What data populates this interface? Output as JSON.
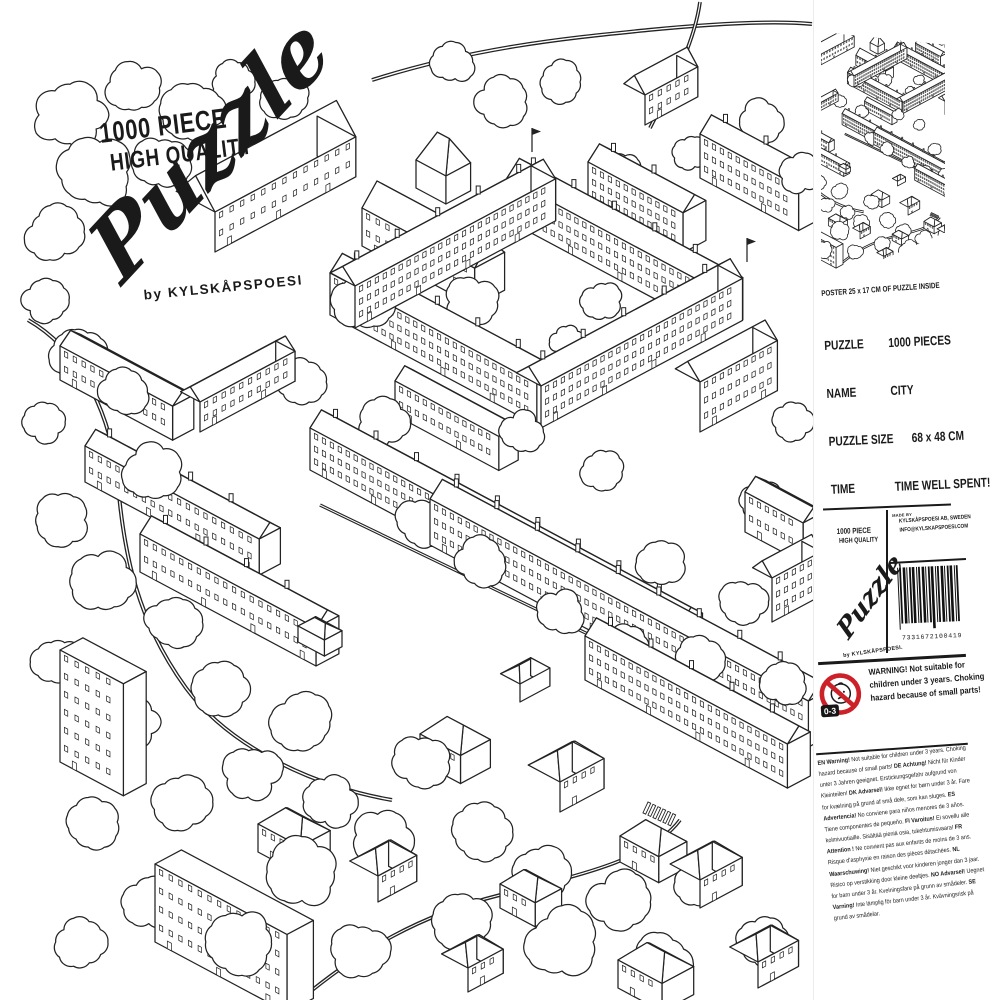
{
  "brand": {
    "line1": "1000 PIECE",
    "line2": "HIGH QUALITY",
    "script": "Puzzle",
    "byline": "by KYLSKÅPSPOESI"
  },
  "side": {
    "poster_caption": "POSTER 25 x 17 CM OF PUZZLE INSIDE",
    "specs": [
      {
        "label": "PUZZLE",
        "value": "1000 PIECES"
      },
      {
        "label": "NAME",
        "value": "CITY"
      },
      {
        "label": "PUZZLE SIZE",
        "value": "68 x 48 CM"
      },
      {
        "label": "TIME",
        "value": "TIME WELL SPENT!"
      }
    ],
    "mini_byline": "by KYLSKÅPSPOESI.",
    "made_by_label": "MADE BY",
    "company": "KYLSKÅPSPOESI AB, SWEDEN",
    "email": "INFO@KYLSKAPSPOESI.COM",
    "barcode_digits": "7331672100419",
    "age_range": "0-3",
    "warning_text": "WARNING! Not suitable for children under 3 years. Choking hazard because of small parts!",
    "legal": [
      {
        "code": "EN",
        "head": "Warning!",
        "text": "Not suitable for children under 3 years. Choking hazard because of small parts!"
      },
      {
        "code": "DE",
        "head": "Achtung!",
        "text": "Nicht für Kinder unter 3 Jahren geeignet. Erstickungsgefahr aufgrund von Kleinteilen!"
      },
      {
        "code": "DK",
        "head": "Advarsel!",
        "text": "Ikke egnet for børn under 3 år. Fare for kvælning på grund af små dele, som kan sluges."
      },
      {
        "code": "ES",
        "head": "Advertencia!",
        "text": "No conviene para niños menores de 3 años. Tiene componentes de pequeño."
      },
      {
        "code": "FI",
        "head": "Varoitus!",
        "text": "Ei sovellu alle kolmivuotiaille. Sisältää pieniä osia, tukehtumisvaara!"
      },
      {
        "code": "FR",
        "head": "Attention !",
        "text": "Ne convient pas aux enfants de moins de 3 ans. Risque d'asphyxie en raison des pièces détachées."
      },
      {
        "code": "NL",
        "head": "Waarschuwing!",
        "text": "Niet geschikt voor kinderen jonger dan 3 jaar. Risico op verstikking door kleine deeltjes."
      },
      {
        "code": "NO",
        "head": "Advarsel!",
        "text": "Uegnet for barn under 3 år. Kvelningsfare på grunn av smådeler."
      },
      {
        "code": "SE",
        "head": "Varning!",
        "text": "Inte lämplig för barn under 3 år. Kvävningsrisk på grund av smådelar."
      }
    ]
  },
  "colors": {
    "ink": "#232323",
    "warning_red": "#cc2128",
    "paper": "#ffffff"
  }
}
